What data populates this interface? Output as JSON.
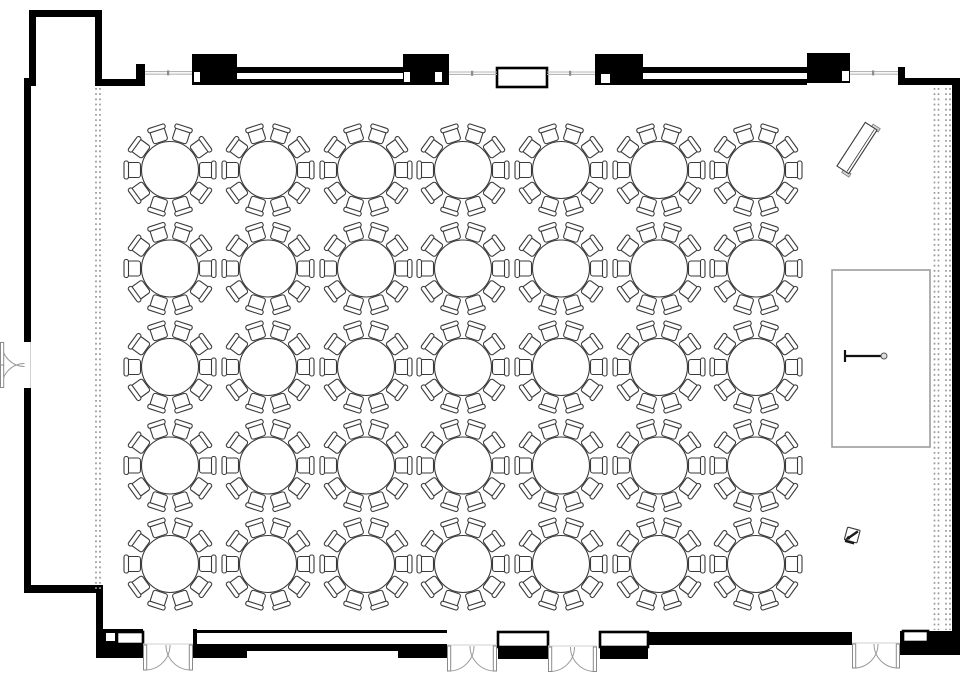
{
  "canvas": {
    "width": 960,
    "height": 690,
    "background": "#ffffff"
  },
  "colors": {
    "wall": "#000000",
    "furniture_outline": "#3a3a3a",
    "glazing_line": "#b5b5b5",
    "drape_dotted_line": "#9a9a9a",
    "door_swing": "#9a9a9a",
    "stage_outline": "#9c9c9c"
  },
  "banquet_tables": {
    "table_count": 35,
    "rows": 5,
    "columns": 7,
    "chairs_per_table": 10,
    "total_chairs": 350,
    "column_centers_x": [
      170,
      268,
      366,
      463,
      561,
      659,
      756
    ],
    "row_centers_y": [
      170,
      268.5,
      367,
      465.5,
      564
    ],
    "table_radius": 28.5,
    "chair_angle_step_deg": 36,
    "chair_start_angle_deg": 0
  },
  "stage": {
    "x": 832,
    "y": 270,
    "width": 98,
    "height": 177,
    "microphone": {
      "x1": 845,
      "x2": 881,
      "y": 356,
      "circle_x": 884,
      "circle_r": 3
    }
  },
  "doors": {
    "bottom_double_doors": [
      {
        "x": 143,
        "width": 50,
        "face_y": 645
      },
      {
        "x": 447,
        "width": 50,
        "face_y": 646
      },
      {
        "x": 548,
        "width": 49,
        "face_y": 647
      },
      {
        "x": 852,
        "width": 48,
        "face_y": 644
      }
    ],
    "left_double_door": {
      "wall_x": 24.5,
      "y": 342,
      "height": 46
    }
  },
  "drape_lines": [
    {
      "x": 96,
      "y1": 88,
      "y2": 591
    },
    {
      "x": 100,
      "y1": 88,
      "y2": 591
    },
    {
      "x": 934.5,
      "y1": 88,
      "y2": 630
    },
    {
      "x": 938.5,
      "y1": 88,
      "y2": 630
    },
    {
      "x": 946,
      "y1": 88,
      "y2": 630
    },
    {
      "x": 950,
      "y1": 88,
      "y2": 630
    }
  ],
  "misc_furniture": {
    "angled_table": {
      "cx": 857,
      "cy": 148,
      "width": 14,
      "length": 52,
      "rotation_deg": 33
    },
    "av_equipment": {
      "cx": 852,
      "cy": 536,
      "rotation_deg": 15
    }
  }
}
